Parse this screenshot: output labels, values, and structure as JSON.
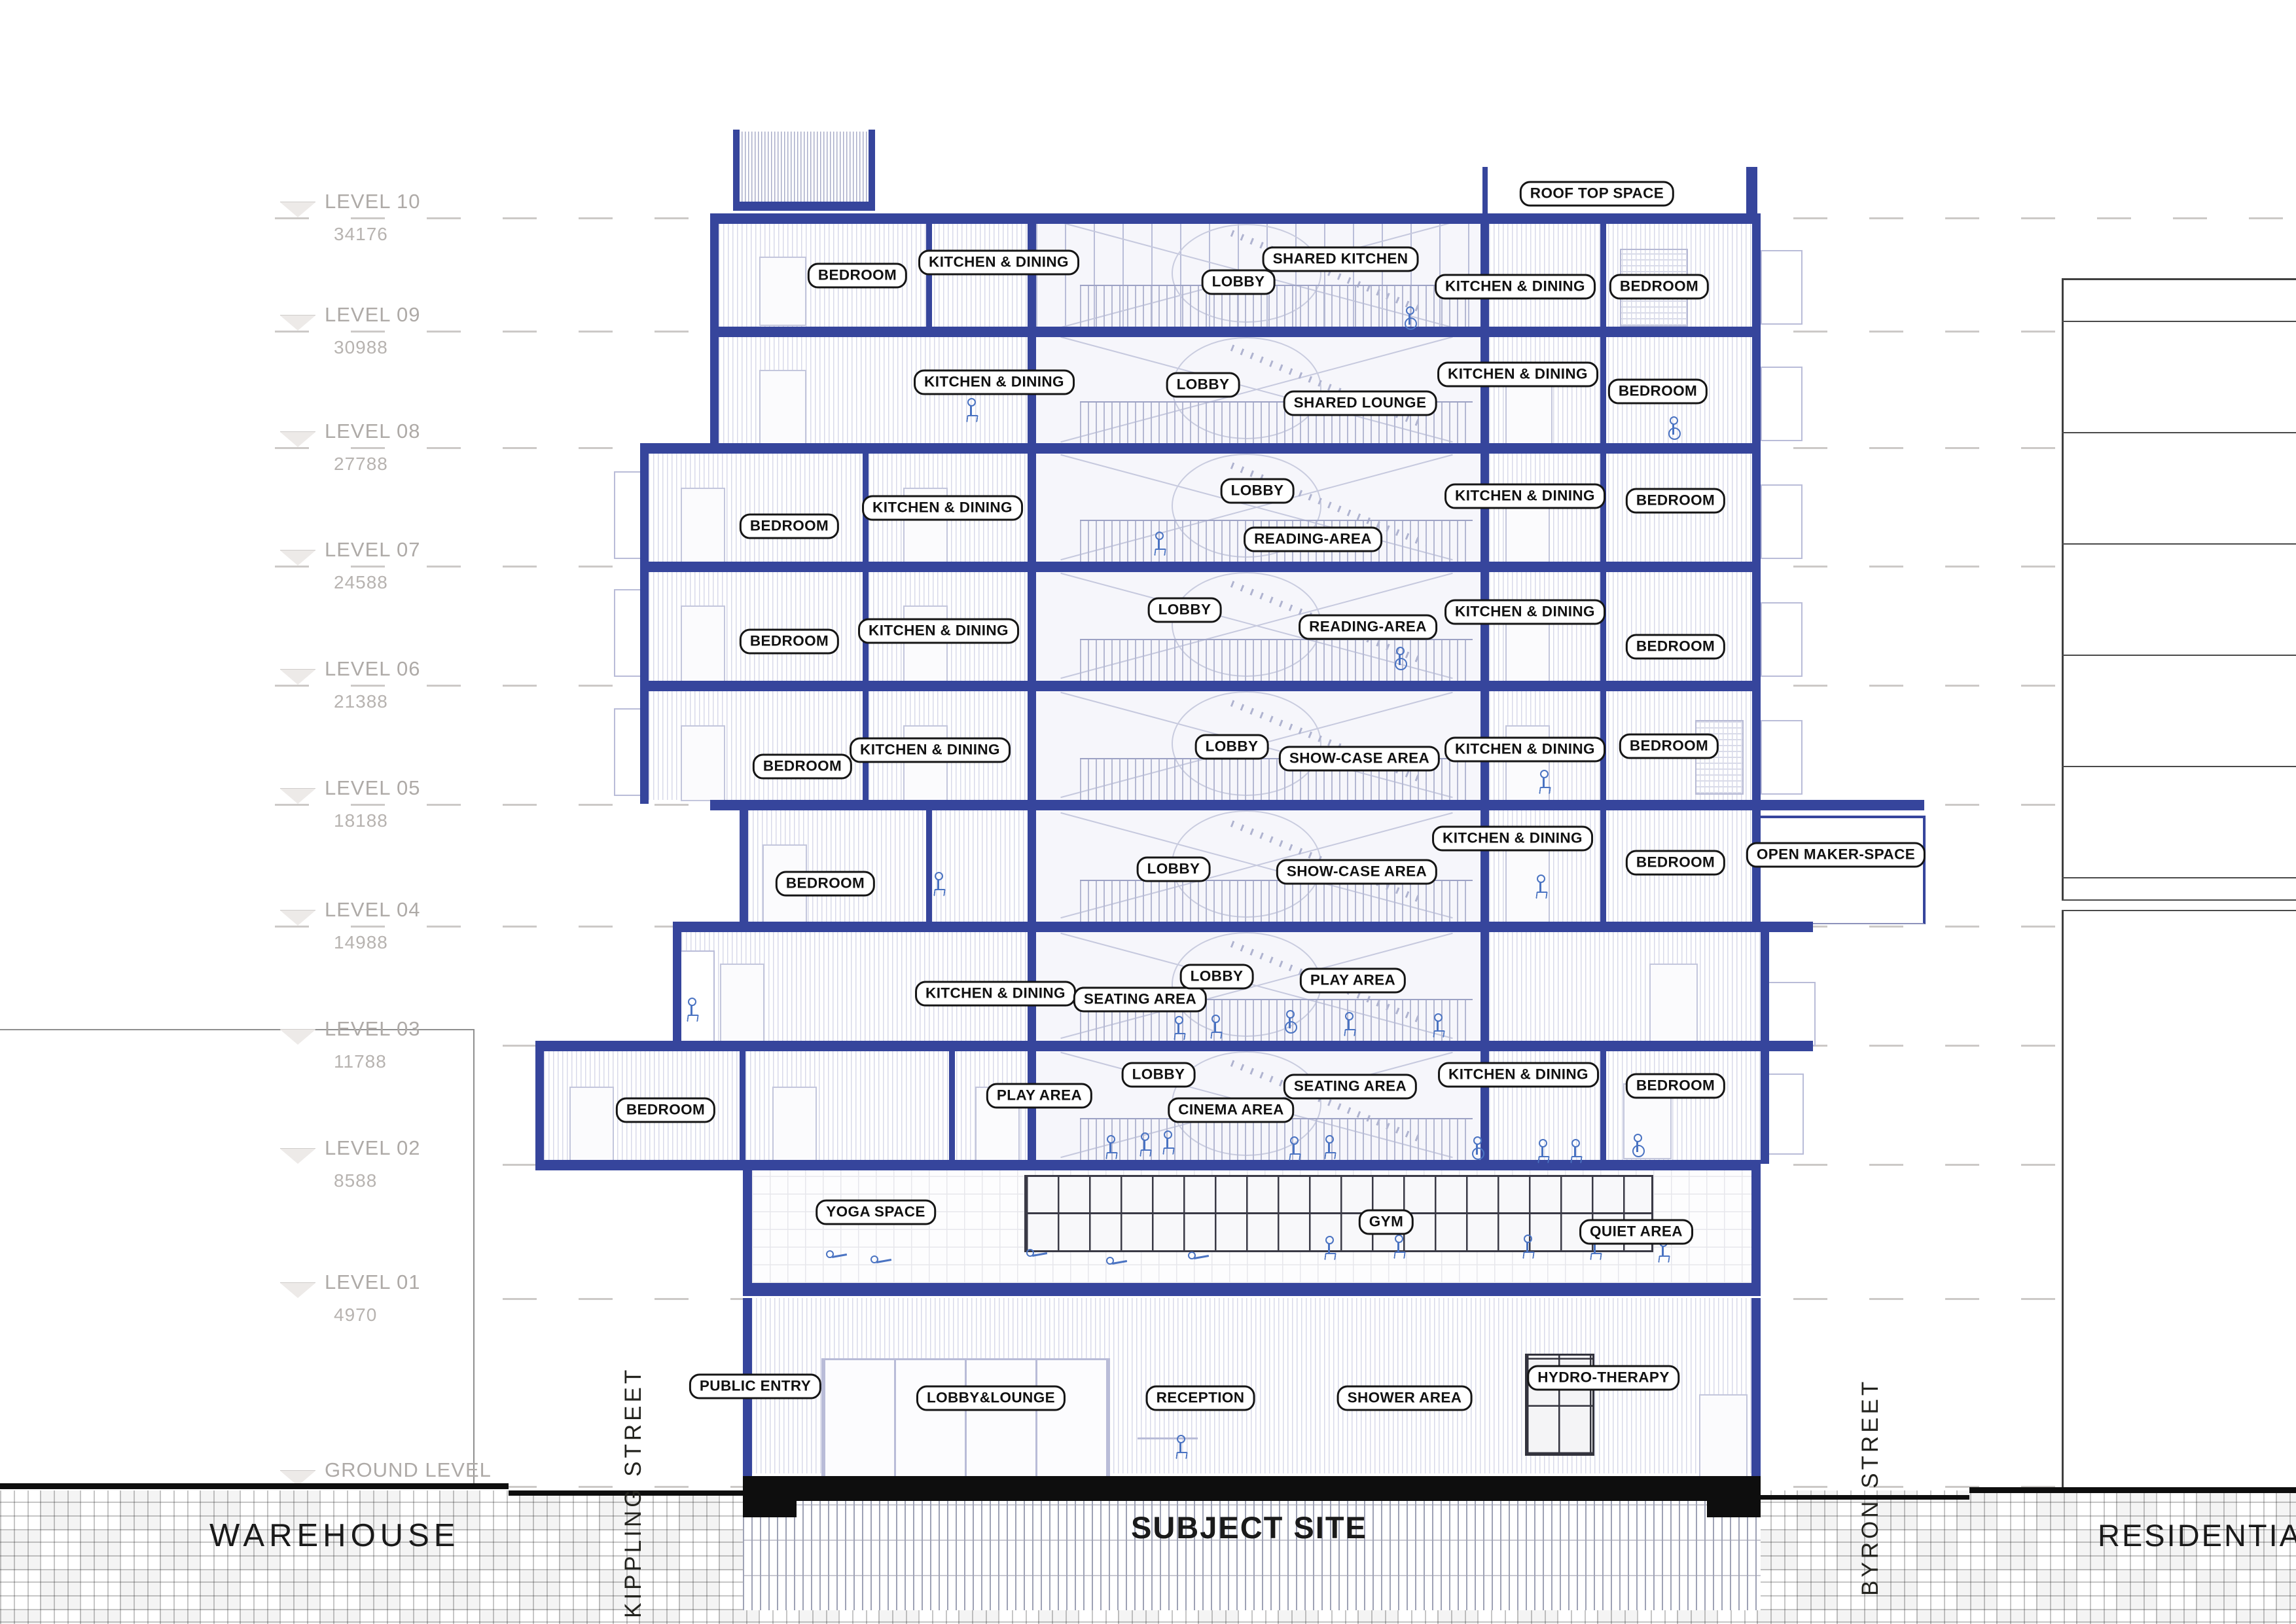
{
  "drawing": {
    "type": "building cross-section",
    "site_label_center": "SUBJECT SITE"
  },
  "colors": {
    "structure_blue": "#36459c",
    "linework_lavender": "#c0c3da",
    "figure_blue": "#4a73c2",
    "label_border": "#151515",
    "level_text": "#aeaaa7",
    "ground_text": "#1a1a1a"
  },
  "levels": [
    {
      "name": "LEVEL 10",
      "elev": "34176"
    },
    {
      "name": "LEVEL 09",
      "elev": "30988"
    },
    {
      "name": "LEVEL 08",
      "elev": "27788"
    },
    {
      "name": "LEVEL 07",
      "elev": "24588"
    },
    {
      "name": "LEVEL 06",
      "elev": "21388"
    },
    {
      "name": "LEVEL 05",
      "elev": "18188"
    },
    {
      "name": "LEVEL 04",
      "elev": "14988"
    },
    {
      "name": "LEVEL 03",
      "elev": "11788"
    },
    {
      "name": "LEVEL 02",
      "elev": "8588"
    },
    {
      "name": "LEVEL 01",
      "elev": "4970"
    },
    {
      "name": "GROUND LEVEL",
      "elev": "0"
    }
  ],
  "rooms": [
    {
      "floor": "roof",
      "label": "ROOF TOP SPACE"
    },
    {
      "floor": "level-10",
      "label": "BEDROOM"
    },
    {
      "floor": "level-10",
      "label": "KITCHEN & DINING"
    },
    {
      "floor": "level-10",
      "label": "LOBBY"
    },
    {
      "floor": "level-10",
      "label": "SHARED KITCHEN"
    },
    {
      "floor": "level-10",
      "label": "KITCHEN & DINING"
    },
    {
      "floor": "level-10",
      "label": "BEDROOM"
    },
    {
      "floor": "level-09",
      "label": "KITCHEN & DINING"
    },
    {
      "floor": "level-09",
      "label": "LOBBY"
    },
    {
      "floor": "level-09",
      "label": "SHARED LOUNGE"
    },
    {
      "floor": "level-09",
      "label": "KITCHEN & DINING"
    },
    {
      "floor": "level-09",
      "label": "BEDROOM"
    },
    {
      "floor": "level-08",
      "label": "BEDROOM"
    },
    {
      "floor": "level-08",
      "label": "KITCHEN & DINING"
    },
    {
      "floor": "level-08",
      "label": "LOBBY"
    },
    {
      "floor": "level-08",
      "label": "READING-AREA"
    },
    {
      "floor": "level-08",
      "label": "KITCHEN & DINING"
    },
    {
      "floor": "level-08",
      "label": "BEDROOM"
    },
    {
      "floor": "level-07",
      "label": "BEDROOM"
    },
    {
      "floor": "level-07",
      "label": "KITCHEN & DINING"
    },
    {
      "floor": "level-07",
      "label": "LOBBY"
    },
    {
      "floor": "level-07",
      "label": "READING-AREA"
    },
    {
      "floor": "level-07",
      "label": "KITCHEN & DINING"
    },
    {
      "floor": "level-07",
      "label": "BEDROOM"
    },
    {
      "floor": "level-06",
      "label": "BEDROOM"
    },
    {
      "floor": "level-06",
      "label": "KITCHEN & DINING"
    },
    {
      "floor": "level-06",
      "label": "LOBBY"
    },
    {
      "floor": "level-06",
      "label": "SHOW-CASE AREA"
    },
    {
      "floor": "level-06",
      "label": "KITCHEN & DINING"
    },
    {
      "floor": "level-06",
      "label": "BEDROOM"
    },
    {
      "floor": "level-05",
      "label": "BEDROOM"
    },
    {
      "floor": "level-05",
      "label": "LOBBY"
    },
    {
      "floor": "level-05",
      "label": "SHOW-CASE AREA"
    },
    {
      "floor": "level-05",
      "label": "KITCHEN & DINING"
    },
    {
      "floor": "level-05",
      "label": "BEDROOM"
    },
    {
      "floor": "level-05",
      "label": "OPEN MAKER-SPACE"
    },
    {
      "floor": "level-04",
      "label": "KITCHEN & DINING"
    },
    {
      "floor": "level-04",
      "label": "SEATING AREA"
    },
    {
      "floor": "level-04",
      "label": "LOBBY"
    },
    {
      "floor": "level-04",
      "label": "PLAY AREA"
    },
    {
      "floor": "level-03",
      "label": "BEDROOM"
    },
    {
      "floor": "level-03",
      "label": "PLAY AREA"
    },
    {
      "floor": "level-03",
      "label": "LOBBY"
    },
    {
      "floor": "level-03",
      "label": "CINEMA AREA"
    },
    {
      "floor": "level-03",
      "label": "SEATING AREA"
    },
    {
      "floor": "level-03",
      "label": "KITCHEN & DINING"
    },
    {
      "floor": "level-03",
      "label": "BEDROOM"
    },
    {
      "floor": "level-02",
      "label": "YOGA SPACE"
    },
    {
      "floor": "level-02",
      "label": "GYM"
    },
    {
      "floor": "level-02",
      "label": "QUIET AREA"
    },
    {
      "floor": "ground-floor",
      "label": "PUBLIC ENTRY"
    },
    {
      "floor": "ground-floor",
      "label": "LOBBY&LOUNGE"
    },
    {
      "floor": "ground-floor",
      "label": "RECEPTION"
    },
    {
      "floor": "ground-floor",
      "label": "SHOWER AREA"
    },
    {
      "floor": "ground-floor",
      "label": "HYDRO-THERAPY"
    }
  ],
  "site": {
    "warehouse": "WAREHOUSE",
    "subject_site": "SUBJECT SITE",
    "residential": "RESIDENTIAL T",
    "street_left": "KIPPLING STREET",
    "street_right": "BYRON STREET"
  }
}
